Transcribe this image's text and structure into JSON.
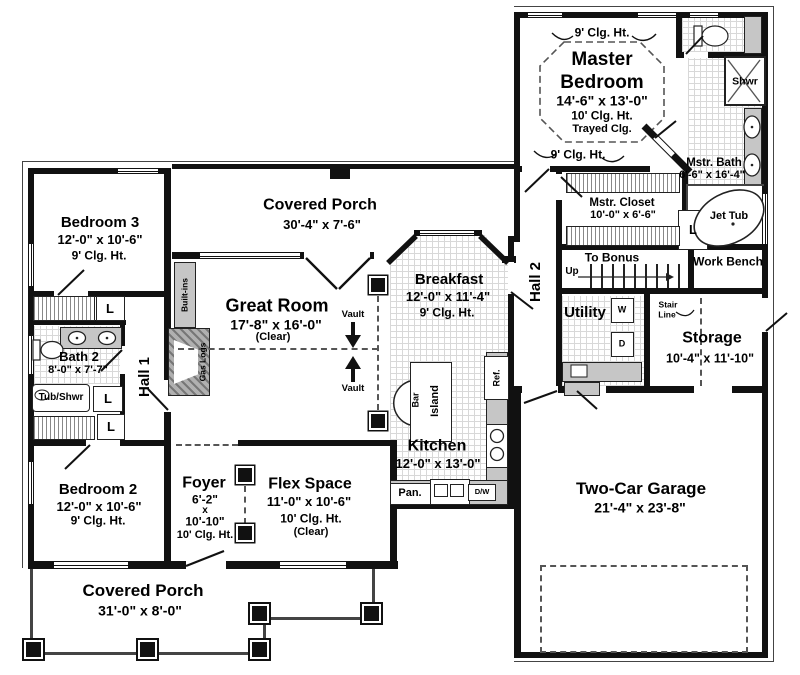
{
  "canvas": {
    "width": 800,
    "height": 675
  },
  "colors": {
    "wall": "#111111",
    "tile_line": "#d8d8d8",
    "fixture_gray": "#c6c6c6",
    "dash": "#555555"
  },
  "rooms": {
    "master_bedroom": {
      "line1": "Master",
      "line2": "Bedroom",
      "dims": "14'-6\" x 13'-0\"",
      "clg": "10' Clg. Ht.",
      "tray": "Trayed Clg.",
      "clg9_top": "9' Clg. Ht.",
      "clg9_side": "9' Clg. Ht."
    },
    "mstr_bath": {
      "name": "Mstr. Bath",
      "dims": "6'-6\" x 16'-4\""
    },
    "shower": {
      "name": "Shwr"
    },
    "jet_tub": {
      "name": "Jet Tub"
    },
    "mstr_closet": {
      "name": "Mstr. Closet",
      "dims": "10'-0\" x 6'-6\""
    },
    "hall2": {
      "name": "Hall 2"
    },
    "stairs": {
      "to_bonus": "To Bonus",
      "up": "Up"
    },
    "work_bench": {
      "name": "Work Bench"
    },
    "utility": {
      "name": "Utility",
      "washer": "W",
      "dryer": "D"
    },
    "stair_line": {
      "line1": "Stair",
      "line2": "Line"
    },
    "storage": {
      "name": "Storage",
      "dims": "10'-4\" x 11'-10\""
    },
    "garage": {
      "name": "Two-Car Garage",
      "dims": "21'-4\" x 23'-8\""
    },
    "porch_top": {
      "name": "Covered Porch",
      "dims": "30'-4\" x 7'-6\""
    },
    "bedroom3": {
      "name": "Bedroom 3",
      "dims": "12'-0\" x 10'-6\"",
      "clg": "9' Clg. Ht."
    },
    "great_room": {
      "name": "Great Room",
      "dims": "17'-8\" x 16'-0\"",
      "clear": "(Clear)",
      "vault": "Vault",
      "built_ins": "Built-ins",
      "gas_logs": "Gas Logs"
    },
    "breakfast": {
      "name": "Breakfast",
      "dims": "12'-0\" x 11'-4\"",
      "clg": "9' Clg. Ht."
    },
    "bath2": {
      "name": "Bath 2",
      "dims": "8'-0\" x 7'-7\"",
      "tub": "Tub/Shwr"
    },
    "hall1": {
      "name": "Hall 1"
    },
    "linen": "L",
    "bedroom2": {
      "name": "Bedroom 2",
      "dims": "12'-0\" x 10'-6\"",
      "clg": "9' Clg. Ht."
    },
    "foyer": {
      "name": "Foyer",
      "dim_w": "6'-2\"",
      "dim_x": "x",
      "dim_l": "10'-10\"",
      "clg": "10' Clg. Ht."
    },
    "flex": {
      "name": "Flex Space",
      "dims": "11'-0\" x 10'-6\"",
      "clg": "10' Clg. Ht.",
      "clear": "(Clear)"
    },
    "kitchen": {
      "name": "Kitchen",
      "dims": "12'-0\" x 13'-0\"",
      "bar": "Bar",
      "island": "Island",
      "ref": "Ref.",
      "pantry": "Pan.",
      "dw": "D/W"
    },
    "porch_bottom": {
      "name": "Covered Porch",
      "dims": "31'-0\" x 8'-0\""
    }
  }
}
